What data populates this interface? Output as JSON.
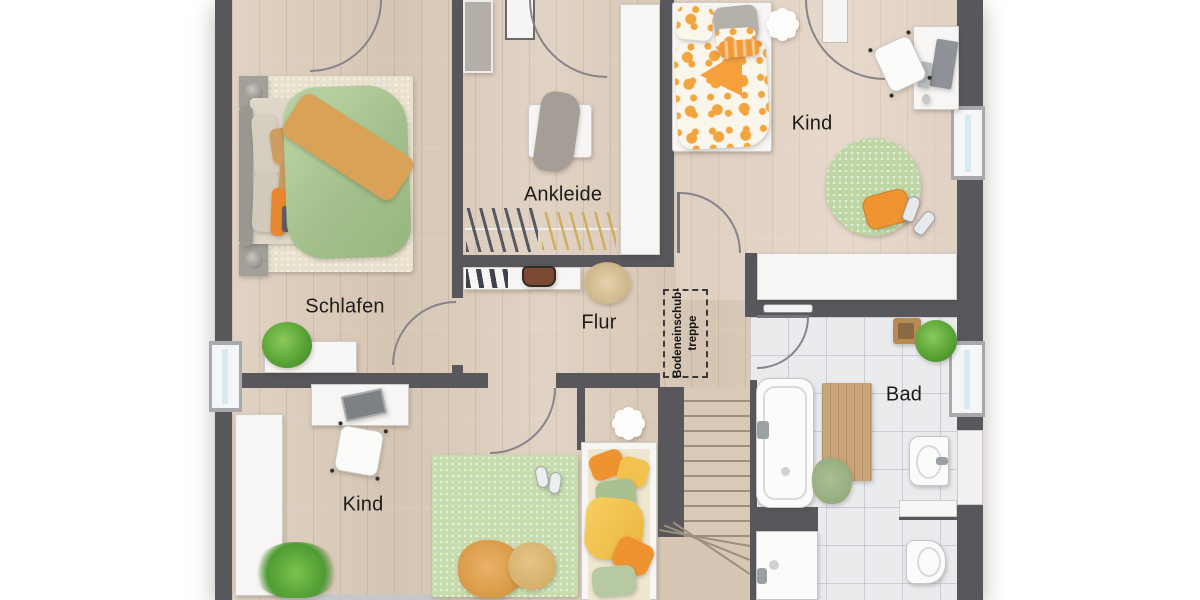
{
  "figure_type": "floor-plan",
  "rooms": {
    "schlafen": "Schlafen",
    "ankleide": "Ankleide",
    "kind_top": "Kind",
    "flur": "Flur",
    "kind_bottom": "Kind",
    "bad": "Bad"
  },
  "annotations": {
    "attic_ladder": {
      "line1": "Bodeneinschub-",
      "line2": "treppe"
    }
  },
  "palette": {
    "wall": "#58585c",
    "wood_floor": "#ddcdbc",
    "tile_floor": "#e9ebed",
    "duvet_green": "#abc795",
    "throw_orange": "#d9a257",
    "kid_orange": "#f2a43e",
    "rug_green": "#c3d9ab",
    "window_glass": "#d9e9f2"
  }
}
